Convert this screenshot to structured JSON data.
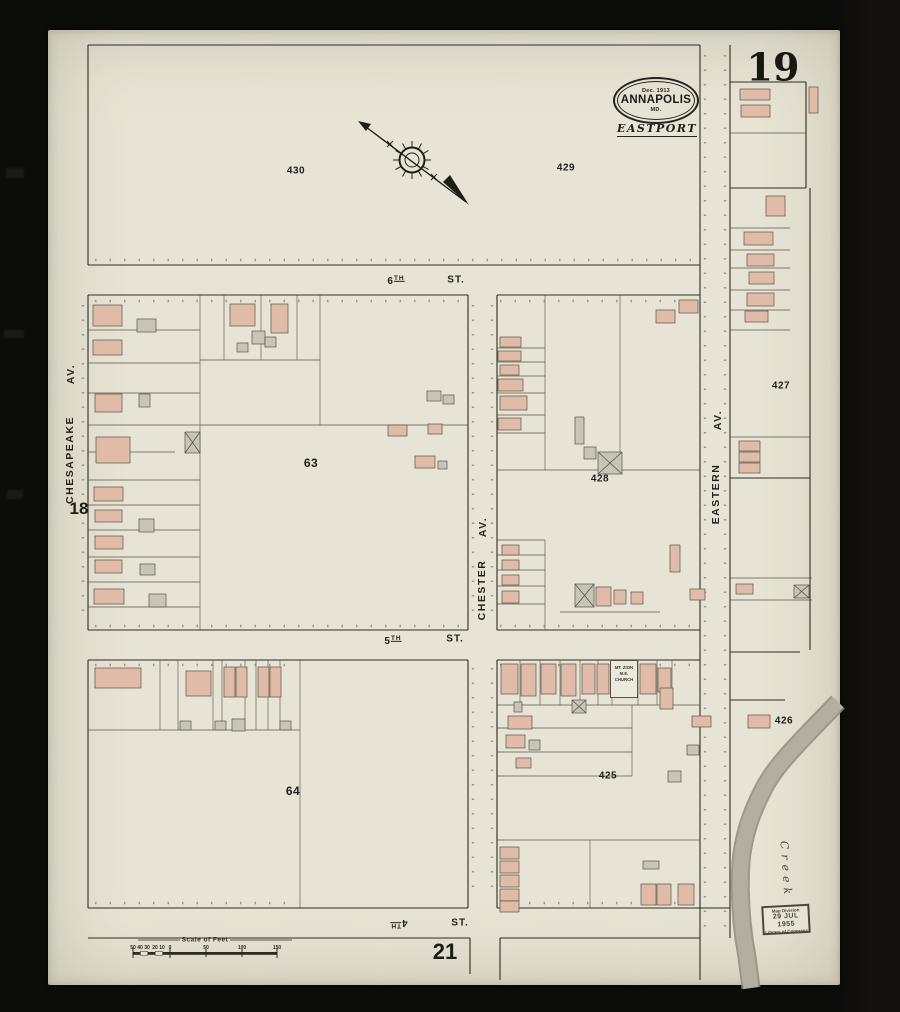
{
  "page": {
    "sheet_number": "19",
    "adjacent_sheet_left": "18",
    "adjacent_sheet_bottom": "21"
  },
  "title": {
    "date": "Dec. 1913",
    "city": "ANNAPOLIS",
    "state": "MD.",
    "district": "EASTPORT"
  },
  "streets": {
    "sixth": {
      "num": "6",
      "sup": "TH",
      "suffix": "ST."
    },
    "fifth": {
      "num": "5",
      "sup": "TH",
      "suffix": "ST."
    },
    "fourth": {
      "num": "4",
      "sup": "TH",
      "suffix": "ST."
    },
    "chesapeake": {
      "name": "CHESAPEAKE",
      "suffix": "AV."
    },
    "chester": {
      "name": "CHESTER",
      "suffix": "AV."
    },
    "eastern": {
      "name": "EASTERN",
      "suffix": "AV."
    }
  },
  "blocks": {
    "b430": "430",
    "b429": "429",
    "b428": "428",
    "b427": "427",
    "b426": "426",
    "b425": "425",
    "b63": "63",
    "b64": "64"
  },
  "annotations": {
    "church_line1": "MT. ZION",
    "church_line2": "M.E. CHURCH",
    "creek": "Creek",
    "scale_title": "Scale of Feet",
    "scale_ticks": [
      "50",
      "40",
      "30",
      "20",
      "10",
      "0",
      "50",
      "100",
      "150"
    ],
    "stamp_line1": "Map Division",
    "stamp_line2": "29 JUL 1955",
    "stamp_line3": "Library of Congress"
  },
  "colors": {
    "paper": "#e8e4d5",
    "line": "#2e2c25",
    "pink": "#e0bca8",
    "gray": "#c8c5b6",
    "white_bldg": "#edeadb",
    "creek": "#b2afa0"
  },
  "map": {
    "buildings": [
      [
        740,
        89,
        30,
        11,
        "p",
        0
      ],
      [
        741,
        105,
        29,
        12,
        "p",
        0
      ],
      [
        809,
        87,
        9,
        26,
        "p",
        0
      ],
      [
        766,
        196,
        19,
        20,
        "p",
        0
      ],
      [
        744,
        232,
        29,
        13,
        "p",
        0
      ],
      [
        747,
        254,
        27,
        12,
        "p",
        0
      ],
      [
        749,
        272,
        25,
        12,
        "p",
        0
      ],
      [
        747,
        293,
        27,
        13,
        "p",
        0
      ],
      [
        745,
        311,
        23,
        11,
        "p",
        0
      ],
      [
        679,
        300,
        19,
        13,
        "p",
        0
      ],
      [
        656,
        310,
        19,
        13,
        "p",
        0
      ],
      [
        739,
        441,
        21,
        10,
        "p",
        0
      ],
      [
        739,
        452,
        21,
        10,
        "p",
        0
      ],
      [
        739,
        463,
        21,
        10,
        "p",
        0
      ],
      [
        736,
        584,
        17,
        10,
        "p",
        0
      ],
      [
        794,
        585,
        15,
        13,
        "g",
        1
      ],
      [
        748,
        715,
        22,
        13,
        "p",
        0
      ],
      [
        93,
        305,
        29,
        21,
        "p",
        0
      ],
      [
        137,
        319,
        19,
        13,
        "g",
        0
      ],
      [
        93,
        340,
        29,
        15,
        "p",
        0
      ],
      [
        230,
        304,
        25,
        22,
        "p",
        0
      ],
      [
        252,
        331,
        13,
        13,
        "g",
        0
      ],
      [
        237,
        343,
        11,
        9,
        "g",
        0
      ],
      [
        271,
        304,
        17,
        29,
        "p",
        0
      ],
      [
        265,
        337,
        11,
        10,
        "g",
        0
      ],
      [
        95,
        394,
        27,
        18,
        "p",
        0
      ],
      [
        139,
        394,
        11,
        13,
        "g",
        0
      ],
      [
        96,
        437,
        34,
        26,
        "p",
        0
      ],
      [
        185,
        432,
        15,
        21,
        "g",
        1
      ],
      [
        94,
        487,
        29,
        14,
        "p",
        0
      ],
      [
        95,
        510,
        27,
        12,
        "p",
        0
      ],
      [
        139,
        519,
        15,
        13,
        "g",
        0
      ],
      [
        95,
        536,
        28,
        13,
        "p",
        0
      ],
      [
        95,
        560,
        27,
        13,
        "p",
        0
      ],
      [
        140,
        564,
        15,
        11,
        "g",
        0
      ],
      [
        94,
        589,
        30,
        15,
        "p",
        0
      ],
      [
        149,
        594,
        17,
        13,
        "g",
        0
      ],
      [
        427,
        391,
        14,
        10,
        "g",
        0
      ],
      [
        443,
        395,
        11,
        9,
        "g",
        0
      ],
      [
        388,
        425,
        19,
        11,
        "p",
        0
      ],
      [
        428,
        424,
        14,
        10,
        "p",
        0
      ],
      [
        415,
        456,
        20,
        12,
        "p",
        0
      ],
      [
        438,
        461,
        9,
        8,
        "g",
        0
      ],
      [
        500,
        337,
        21,
        10,
        "p",
        0
      ],
      [
        498,
        351,
        23,
        10,
        "p",
        0
      ],
      [
        500,
        365,
        19,
        10,
        "p",
        0
      ],
      [
        498,
        379,
        25,
        12,
        "p",
        0
      ],
      [
        500,
        396,
        27,
        14,
        "p",
        0
      ],
      [
        498,
        418,
        23,
        12,
        "p",
        0
      ],
      [
        575,
        417,
        9,
        27,
        "g",
        0
      ],
      [
        584,
        447,
        12,
        12,
        "g",
        0
      ],
      [
        598,
        452,
        24,
        22,
        "g",
        1
      ],
      [
        502,
        545,
        17,
        10,
        "p",
        0
      ],
      [
        502,
        560,
        17,
        10,
        "p",
        0
      ],
      [
        502,
        575,
        17,
        10,
        "p",
        0
      ],
      [
        502,
        591,
        17,
        12,
        "p",
        0
      ],
      [
        575,
        584,
        19,
        23,
        "g",
        1
      ],
      [
        596,
        587,
        15,
        19,
        "p",
        0
      ],
      [
        614,
        590,
        12,
        14,
        "p",
        0
      ],
      [
        631,
        592,
        12,
        12,
        "p",
        0
      ],
      [
        670,
        545,
        10,
        27,
        "p",
        0
      ],
      [
        690,
        589,
        15,
        11,
        "p",
        0
      ],
      [
        95,
        668,
        46,
        20,
        "p",
        0
      ],
      [
        186,
        671,
        25,
        25,
        "p",
        0
      ],
      [
        224,
        667,
        11,
        30,
        "p",
        0
      ],
      [
        236,
        667,
        11,
        30,
        "p",
        0
      ],
      [
        258,
        667,
        11,
        30,
        "p",
        0
      ],
      [
        270,
        667,
        11,
        30,
        "p",
        0
      ],
      [
        180,
        721,
        11,
        9,
        "g",
        0
      ],
      [
        215,
        721,
        11,
        9,
        "g",
        0
      ],
      [
        232,
        719,
        13,
        12,
        "g",
        0
      ],
      [
        280,
        721,
        11,
        9,
        "g",
        0
      ],
      [
        501,
        664,
        17,
        30,
        "p",
        0
      ],
      [
        521,
        664,
        15,
        32,
        "p",
        0
      ],
      [
        541,
        664,
        15,
        30,
        "p",
        0
      ],
      [
        561,
        664,
        15,
        32,
        "p",
        0
      ],
      [
        582,
        664,
        13,
        30,
        "p",
        0
      ],
      [
        597,
        664,
        12,
        30,
        "p",
        0
      ],
      [
        640,
        664,
        16,
        30,
        "p",
        0
      ],
      [
        658,
        668,
        13,
        24,
        "p",
        0
      ],
      [
        572,
        700,
        14,
        13,
        "g",
        1
      ],
      [
        514,
        702,
        8,
        10,
        "g",
        0
      ],
      [
        508,
        716,
        24,
        13,
        "p",
        0
      ],
      [
        506,
        735,
        19,
        13,
        "p",
        0
      ],
      [
        529,
        740,
        11,
        10,
        "g",
        0
      ],
      [
        516,
        758,
        15,
        10,
        "p",
        0
      ],
      [
        660,
        688,
        13,
        21,
        "p",
        0
      ],
      [
        692,
        716,
        19,
        11,
        "p",
        0
      ],
      [
        687,
        745,
        12,
        10,
        "g",
        0
      ],
      [
        668,
        771,
        13,
        11,
        "g",
        0
      ],
      [
        500,
        847,
        19,
        12,
        "p",
        0
      ],
      [
        500,
        861,
        19,
        12,
        "p",
        0
      ],
      [
        500,
        875,
        19,
        12,
        "p",
        0
      ],
      [
        500,
        889,
        19,
        12,
        "p",
        0
      ],
      [
        500,
        901,
        19,
        11,
        "p",
        0
      ],
      [
        643,
        861,
        16,
        8,
        "g",
        0
      ],
      [
        641,
        884,
        15,
        21,
        "p",
        0
      ],
      [
        657,
        884,
        14,
        21,
        "p",
        0
      ],
      [
        678,
        884,
        16,
        21,
        "p",
        0
      ]
    ]
  }
}
